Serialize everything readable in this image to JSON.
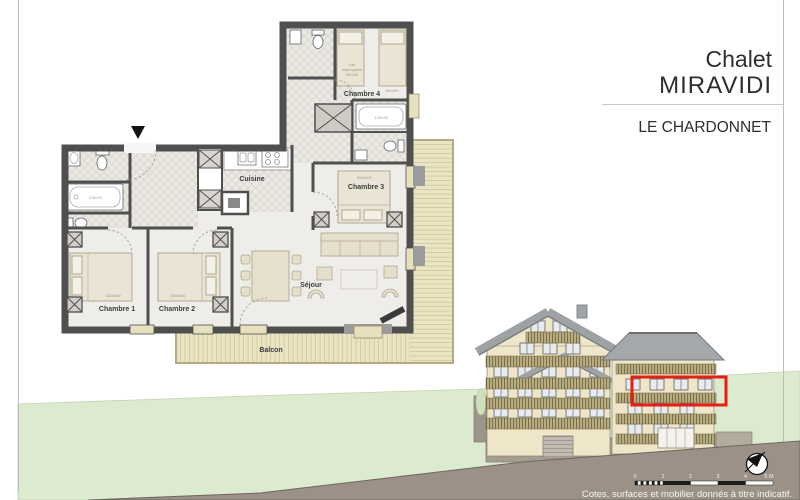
{
  "title_block": {
    "line1": "Chalet",
    "line2": "MIRAVIDI",
    "project_name": "LE CHARDONNET"
  },
  "floor_plan": {
    "rooms": {
      "chambre1": {
        "label": "Chambre 1",
        "bed_size": "160x200"
      },
      "chambre2": {
        "label": "Chambre 2",
        "bed_size": "160x200"
      },
      "chambre3": {
        "label": "Chambre 3",
        "bed_size": "160x200"
      },
      "chambre4": {
        "label": "Chambre 4",
        "bed_size": "90x200",
        "bunk_note_lines": [
          "Lits",
          "superposés",
          "90x200"
        ]
      },
      "cuisine": {
        "label": "Cuisine"
      },
      "sejour": {
        "label": "Séjour"
      },
      "balcon": {
        "label": "Balcon"
      }
    },
    "fixtures": {
      "bathtub1_size": "170x75",
      "bathtub2_size": "170x75"
    }
  },
  "scale_bar": {
    "ticks": [
      "0",
      "1",
      "2",
      "3",
      "4",
      "5 M"
    ]
  },
  "footnote": "Cotes, surfaces et mobilier donnés à titre indicatif.",
  "colors": {
    "highlight_red": "#e61e14",
    "wall_gray": "#4f4f4f",
    "deck_wood": "#eae4c3",
    "hill_green": "#dcead0",
    "ground_taupe": "#9b9186",
    "elevation_wall": "#efe6c9",
    "roof_gray": "#a0a3a6"
  }
}
